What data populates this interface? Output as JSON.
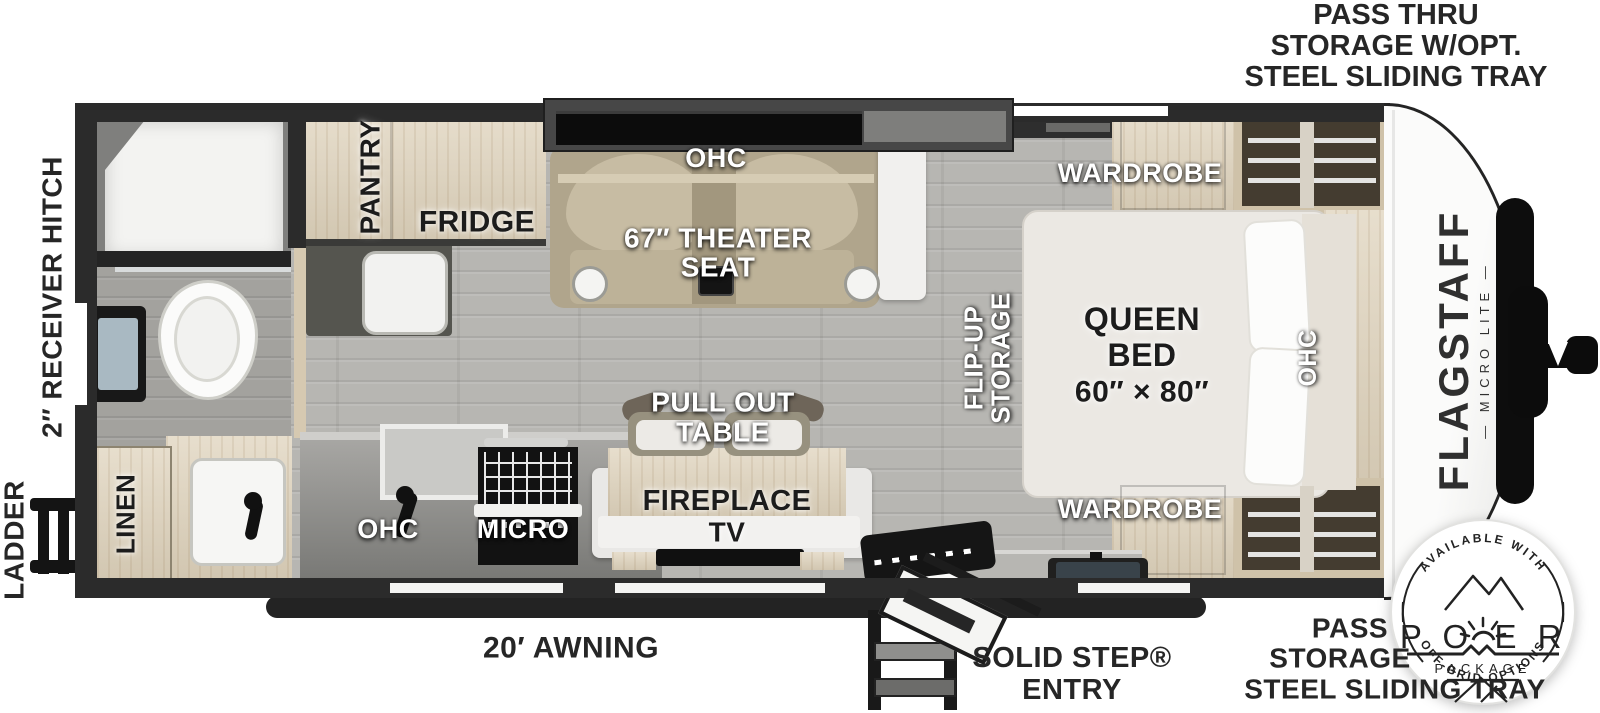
{
  "labels": {
    "pass_thru_top_l1": "PASS THRU",
    "pass_thru_top_l2": "STORAGE W/OPT.",
    "pass_thru_top_l3": "STEEL SLIDING TRAY",
    "receiver_hitch": "2″ RECEIVER HITCH",
    "ladder": "LADDER",
    "pantry": "PANTRY",
    "fridge": "FRIDGE",
    "ohc_living": "OHC",
    "theater_l1": "67″ THEATER",
    "theater_l2": "SEAT",
    "flip_up_l1": "FLIP-UP",
    "flip_up_l2": "STORAGE",
    "wardrobe_top": "WARDROBE",
    "wardrobe_bottom": "WARDROBE",
    "queen_l1": "QUEEN",
    "queen_l2": "BED",
    "queen_l3": "60″ × 80″",
    "ohc_bed": "OHC",
    "pull_out_l1": "PULL OUT",
    "pull_out_l2": "TABLE",
    "fireplace": "FIREPLACE",
    "tv": "TV",
    "ohc_kitchen": "OHC",
    "micro": "MICRO",
    "linen": "LINEN",
    "awning": "20′ AWNING",
    "solid_step_l1": "SOLID STEP®",
    "solid_step_l2": "ENTRY",
    "pass_bottom_l1": "PASS",
    "pass_bottom_l2": "STORAGE",
    "pass_bottom_l3": "STEEL SLIDING TRAY"
  },
  "branding": {
    "model": "FLAGSTAFF",
    "series": "— MICRO LITE —"
  },
  "badge": {
    "top_arc": "AVAILABLE WITH",
    "power_left": "P O",
    "power_right": "E R",
    "package": "PACKAGE",
    "bottom_arc": "OFF-GRID OPTIONS"
  },
  "colors": {
    "wall": "#2b2b2b",
    "floor": "#b7b6b2",
    "wood": "#dfd3bc",
    "sofa": "#b0a58c",
    "bed": "#ebe8e3",
    "label_white": "#ffffff",
    "label_dark": "#1c1c1c"
  }
}
